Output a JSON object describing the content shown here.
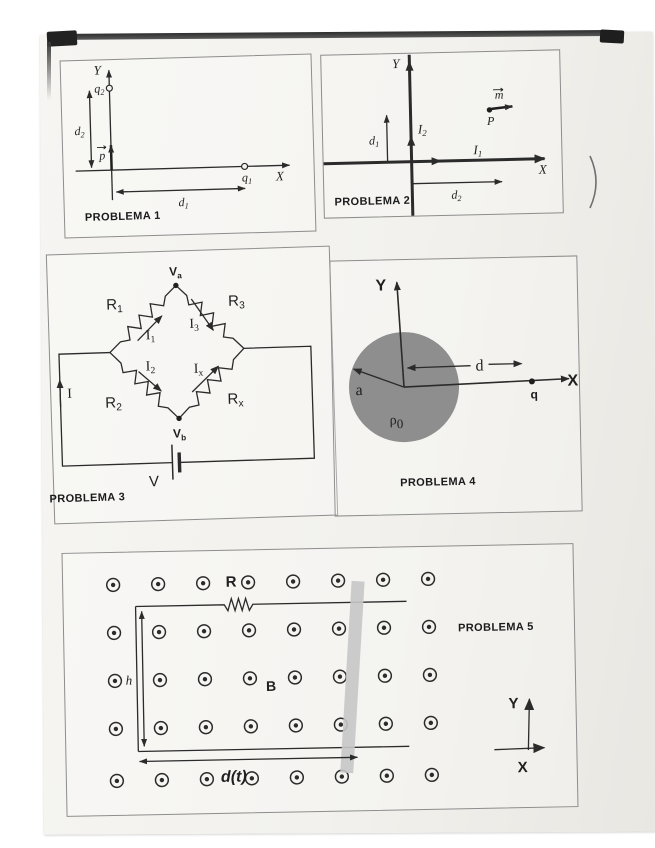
{
  "page": {
    "paper_color": "#f3f2ee",
    "line_color": "#2b2b2b",
    "sphere_color": "#8e8e8e",
    "bar_color": "#c6c6c6"
  },
  "marks": {
    "paren": ")"
  },
  "p1": {
    "title": "PROBLEMA 1",
    "y": "Y",
    "x": "X",
    "q2b": "q",
    "q2s": "2",
    "q1b": "q",
    "q1s": "1",
    "d2b": "d",
    "d2s": "2",
    "d1b": "d",
    "d1s": "1",
    "p": "p"
  },
  "p2": {
    "title": "PROBLEMA 2",
    "y": "Y",
    "x": "X",
    "i1b": "I",
    "i1s": "1",
    "i2b": "I",
    "i2s": "2",
    "d1b": "d",
    "d1s": "1",
    "d2b": "d",
    "d2s": "2",
    "m": "m",
    "pt": "P"
  },
  "p3": {
    "title": "PROBLEMA 3",
    "vab": "V",
    "vas": "a",
    "vbb": "V",
    "vbs": "b",
    "r1b": "R",
    "r1s": "1",
    "r2b": "R",
    "r2s": "2",
    "r3b": "R",
    "r3s": "3",
    "rxb": "R",
    "rxs": "x",
    "i1b": "I",
    "i1s": "1",
    "i2b": "I",
    "i2s": "2",
    "i3b": "I",
    "i3s": "3",
    "ixb": "I",
    "ixs": "x",
    "cur": "I",
    "bat": "V"
  },
  "p4": {
    "title": "PROBLEMA 4",
    "y": "Y",
    "x": "X",
    "a": "a",
    "d": "d",
    "q": "q",
    "rhob": "ρ",
    "rhos": "0"
  },
  "p5": {
    "title": "PROBLEMA 5",
    "r": "R",
    "h": "h",
    "b": "B",
    "dt": "d(t)",
    "y": "Y",
    "x": "X"
  }
}
